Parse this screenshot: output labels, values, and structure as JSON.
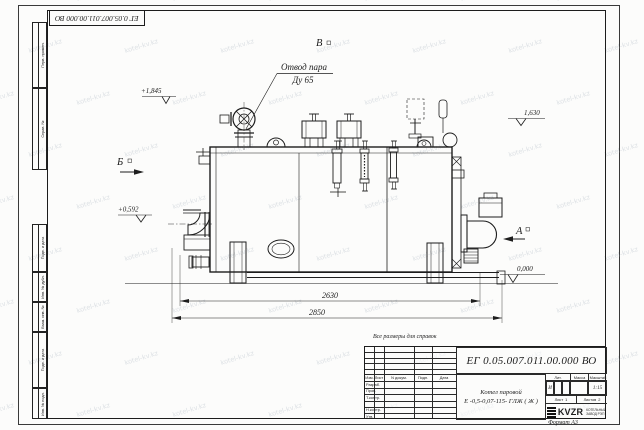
{
  "watermark": {
    "text": "kotel-kv.kz"
  },
  "frame": {
    "format_label": "Формат А3",
    "side_columns": {
      "top": [
        "Перв. примен.",
        "Справ. №"
      ],
      "bottom": [
        "Подп. и дата",
        "Инв. № дубл.",
        "Взам. инв. №",
        "Подп. и дата",
        "Инв. № подл."
      ]
    }
  },
  "title_block": {
    "doc_number": "ЕГ 0.05.007.011.00.000  ВО",
    "note_above": "Все размеры для справок",
    "product_name_line1": "Котел паровой",
    "product_name_line2": "Е -0,5-0,07-115- ГЛЖ ( Ж )",
    "header_cells": [
      "Изм.",
      "Лист",
      "N докум.",
      "Подп.",
      "Дата"
    ],
    "row_labels": [
      "Разраб.",
      "Пров.",
      "Т.контр.",
      "Н.контр.",
      "Утв."
    ],
    "lit_label": "Лит.",
    "lit_value": "И",
    "mass_label": "Масса",
    "scale_label": "Масштаб",
    "scale_value": "1:15",
    "sheet_label": "Лист",
    "sheet_value": "1",
    "sheets_label": "Листов",
    "sheets_value": "2",
    "company_logo": "KVZR",
    "company_line1": "КОТЕЛЬНЫЙ",
    "company_line2": "ЗАВОД РЭП"
  },
  "drawing": {
    "callout_line1": "Отвод пара",
    "callout_line2": "Ду 65",
    "views": {
      "a": "А",
      "b": "Б",
      "v": "В"
    },
    "elevations": {
      "e1": "+1,845",
      "e2": "1,630",
      "e3": "+0,592",
      "e4": "0,000"
    },
    "dimensions": {
      "d1": "2630",
      "d2": "2850"
    }
  }
}
